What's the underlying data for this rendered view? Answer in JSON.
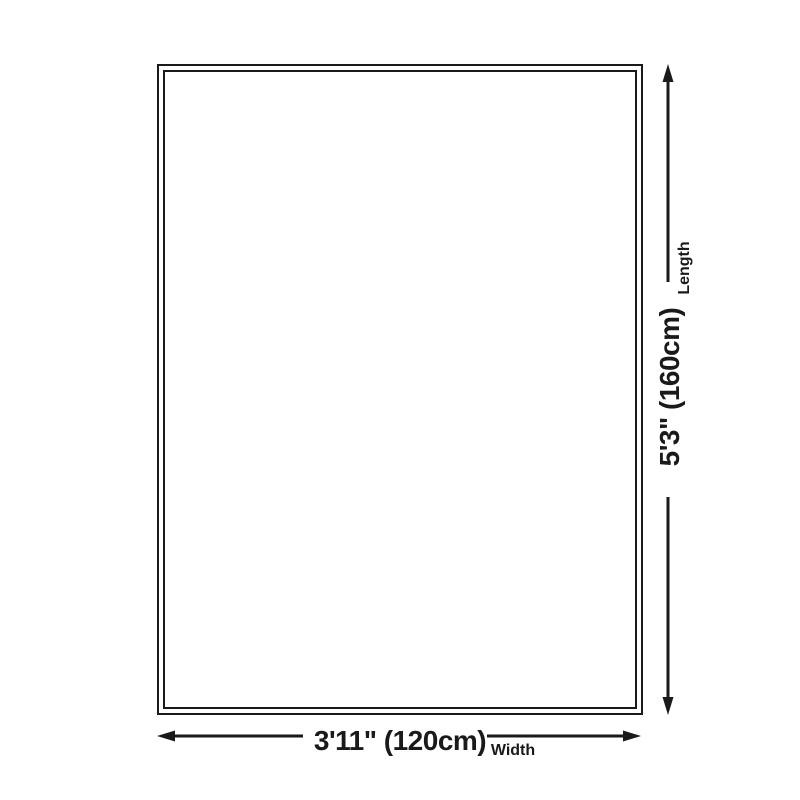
{
  "diagram": {
    "title": "product-size-diagram",
    "width_dimension": {
      "value": "3'11\" (120cm)",
      "label": "Width"
    },
    "length_dimension": {
      "value": "5'3\" (160cm)",
      "label": "Length"
    }
  },
  "colors": {
    "line": "#1a1a1a",
    "background": "#ffffff"
  }
}
